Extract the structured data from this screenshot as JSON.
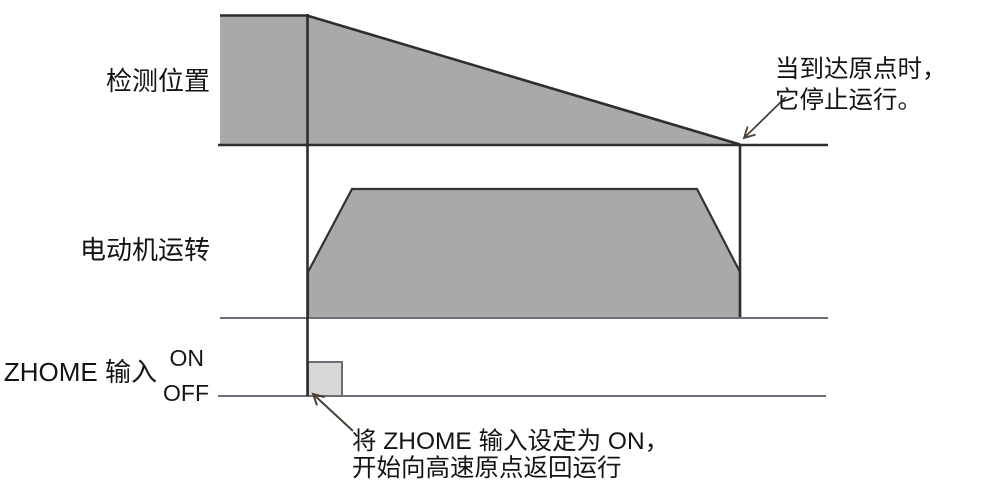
{
  "rows": {
    "detection": {
      "label": "检测位置"
    },
    "motor": {
      "label": "电动机运转"
    },
    "zhome": {
      "label": "ZHOME 输入",
      "on_label": "ON",
      "off_label": "OFF"
    }
  },
  "annotations": {
    "stop": {
      "line1": "当到达原点时，",
      "line2": "它停止运行。"
    },
    "start": {
      "line1": "将 ZHOME 输入设定为 ON，",
      "line2": "开始向高速原点返回运行"
    }
  },
  "colors": {
    "waveform_fill": "#a9a9a9",
    "pulse_fill": "#d8d8d8",
    "line_dark": "#2e2e2e",
    "line_light": "#6e6e78",
    "outline_dark": "#38322e",
    "arrow": "#4a4038",
    "text": "#141414"
  }
}
